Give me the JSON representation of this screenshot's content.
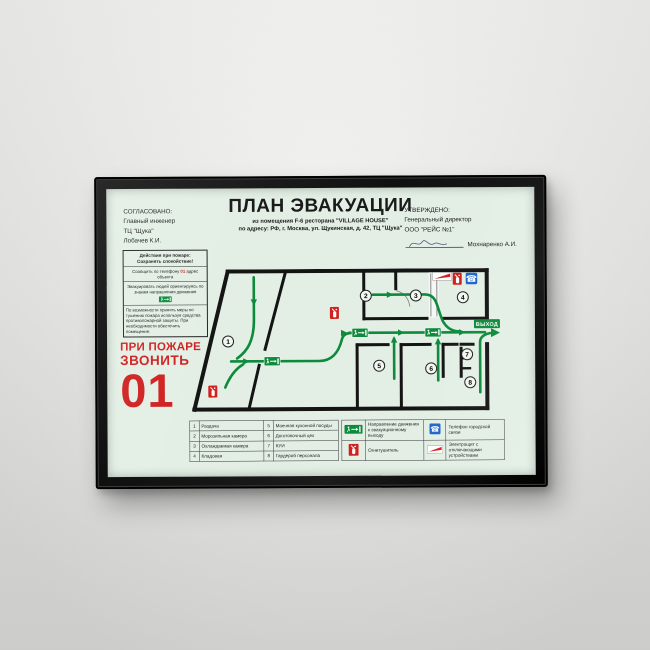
{
  "poster": {
    "title": "ПЛАН ЭВАКУАЦИИ",
    "subtitle_line1": "из помещения F-6 ресторана \"VILLAGE HOUSE\"",
    "subtitle_line2": "по адресу: РФ, г. Москва, ул. Щукинская, д. 42, ТЦ \"Щука\"",
    "agreed": {
      "heading": "СОГЛАСОВАНО:",
      "line1": "Главный инженер",
      "line2": "ТЦ \"Щука\"",
      "line3": "Лобачев К.И."
    },
    "approved": {
      "heading": "УТВЕРЖДЕНО:",
      "line1": "Генеральный директор",
      "line2": "ООО \"РЕЙС №1\"",
      "signature_name": "Мохнаренко А.И."
    },
    "actions_box": {
      "title1": "Действия при пожаре:",
      "title2": "Сохранять спокойствие!",
      "step1_before": "Сообщить по телефону",
      "step1_number": "01",
      "step1_after": "адрес объекта",
      "step2": "Эвакуировать людей ориентируясь по знакам направления движения",
      "step3": "По возможности принять меры по тушению пожара используя средства противопожарной защиты. При необходимости обесточить помещение."
    },
    "emergency": {
      "line1": "ПРИ ПОЖАРЕ",
      "line2": "ЗВОНИТЬ",
      "phone": "01"
    },
    "plan": {
      "exit_label": "ВЫХОД",
      "room_numbers": [
        "1",
        "2",
        "3",
        "4",
        "5",
        "6",
        "7",
        "8"
      ]
    },
    "rooms_legend": [
      {
        "num": "1",
        "name": "Раздача"
      },
      {
        "num": "2",
        "name": "Морозильная камера"
      },
      {
        "num": "3",
        "name": "Охлаждаемая камера"
      },
      {
        "num": "4",
        "name": "Кладовая"
      },
      {
        "num": "5",
        "name": "Моечная кухонной посуды"
      },
      {
        "num": "6",
        "name": "Доготовочный цех"
      },
      {
        "num": "7",
        "name": "КУИ"
      },
      {
        "num": "8",
        "name": "Гардероб персонала"
      }
    ],
    "symbols_legend": [
      {
        "icon": "evacuation-direction-sign",
        "name": "Направление движения к эвакуационному выходу"
      },
      {
        "icon": "fire-extinguisher",
        "name": "Огнетушитель"
      },
      {
        "icon": "city-phone",
        "name": "Телефон городской связи"
      },
      {
        "icon": "electrical-panel",
        "name": "Электрощит с отключающими устройствами"
      }
    ],
    "colors": {
      "poster_bg": "#e3efe5",
      "route_green": "#0e8a3c",
      "alarm_red": "#cf1f1f",
      "phone_blue": "#1f66cc",
      "frame": "#161616"
    }
  }
}
